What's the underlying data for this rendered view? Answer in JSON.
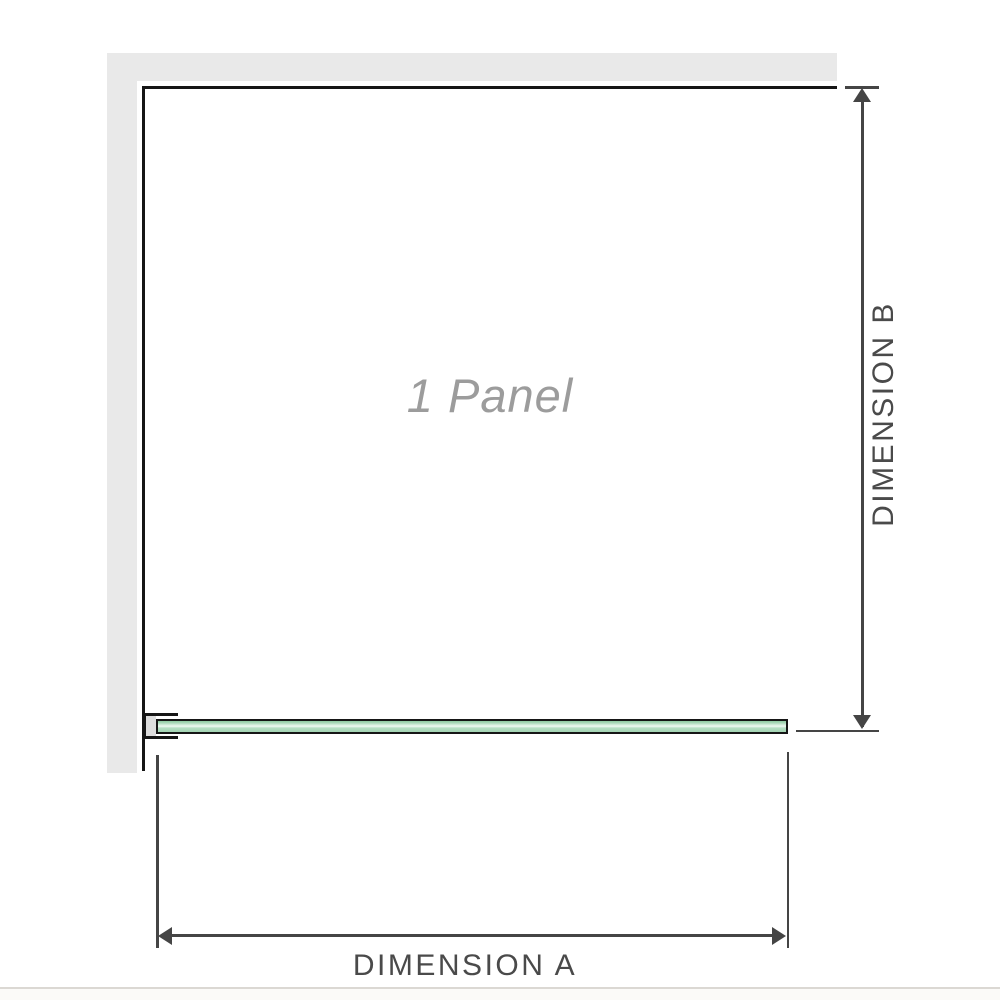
{
  "diagram": {
    "panel_label": "1 Panel",
    "dimension_a": {
      "label": "DIMENSION A",
      "orientation": "horizontal"
    },
    "dimension_b": {
      "label": "DIMENSION B",
      "orientation": "vertical"
    }
  },
  "icons": {
    "dimension_b_top": "arrow-up-icon",
    "dimension_b_bottom": "arrow-down-icon",
    "dimension_a_left": "arrow-left-icon",
    "dimension_a_right": "arrow-right-icon"
  },
  "colors": {
    "background": "#ffffff",
    "wall_fill": "#e9e9e9",
    "wall_edge_line": "#161616",
    "dimension_line": "#454545",
    "dimension_label_text": "#4a4a4a",
    "panel_label_text": "#9c9c9c",
    "glass_green": "#a9d8b8",
    "glass_highlight": "#eef9f1",
    "glass_border": "#161616",
    "bracket_fill": "#dddddd",
    "page_rule": "#dbd8d3"
  }
}
